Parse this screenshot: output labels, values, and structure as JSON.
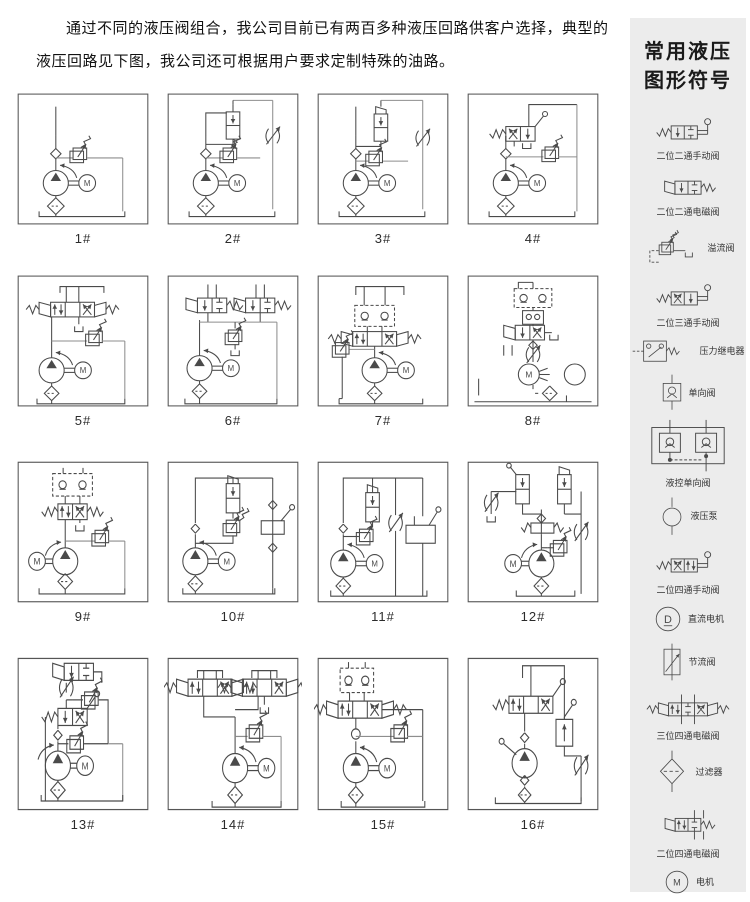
{
  "intro": {
    "text": "通过不同的液压阀组合，我公司目前已有两百多种液压回路供客户选择，典型的液压回路见下图，我公司还可根据用户要求定制特殊的油路。"
  },
  "circuits": [
    {
      "label": "1#"
    },
    {
      "label": "2#"
    },
    {
      "label": "3#"
    },
    {
      "label": "4#"
    },
    {
      "label": "5#"
    },
    {
      "label": "6#"
    },
    {
      "label": "7#"
    },
    {
      "label": "8#"
    },
    {
      "label": "9#"
    },
    {
      "label": "10#"
    },
    {
      "label": "11#"
    },
    {
      "label": "12#"
    },
    {
      "label": "13#"
    },
    {
      "label": "14#"
    },
    {
      "label": "15#"
    },
    {
      "label": "16#"
    }
  ],
  "sidebar": {
    "title_line1": "常用液压",
    "title_line2": "图形符号",
    "background": "#ececec",
    "items": [
      {
        "label": "二位二通手动阀",
        "icon": "valve-2-2-manual-icon"
      },
      {
        "label": "二位二通电磁阀",
        "icon": "valve-2-2-solenoid-icon"
      },
      {
        "label": "溢流阀",
        "icon": "relief-valve-icon"
      },
      {
        "label": "二位三通手动阀",
        "icon": "valve-2-3-manual-icon"
      },
      {
        "label": "压力继电器",
        "icon": "pressure-relay-icon"
      },
      {
        "label": "单向阀",
        "icon": "check-valve-icon"
      },
      {
        "label": "液控单向阀",
        "icon": "pilot-check-valve-icon"
      },
      {
        "label": "液压泵",
        "icon": "hydraulic-pump-icon"
      },
      {
        "label": "二位四通手动阀",
        "icon": "valve-2-4-manual-icon"
      },
      {
        "label": "直流电机",
        "icon": "dc-motor-icon"
      },
      {
        "label": "节流阀",
        "icon": "throttle-valve-icon"
      },
      {
        "label": "三位四通电磁阀",
        "icon": "valve-3-4-solenoid-icon"
      },
      {
        "label": "过滤器",
        "icon": "filter-icon"
      },
      {
        "label": "二位四通电磁阀",
        "icon": "valve-2-4-solenoid-icon"
      },
      {
        "label": "电机",
        "icon": "motor-icon"
      }
    ]
  },
  "colors": {
    "line": "#4a4a4a",
    "line_light": "#8e8e8e",
    "sidebar_bg": "#ececec",
    "text": "#111111"
  }
}
